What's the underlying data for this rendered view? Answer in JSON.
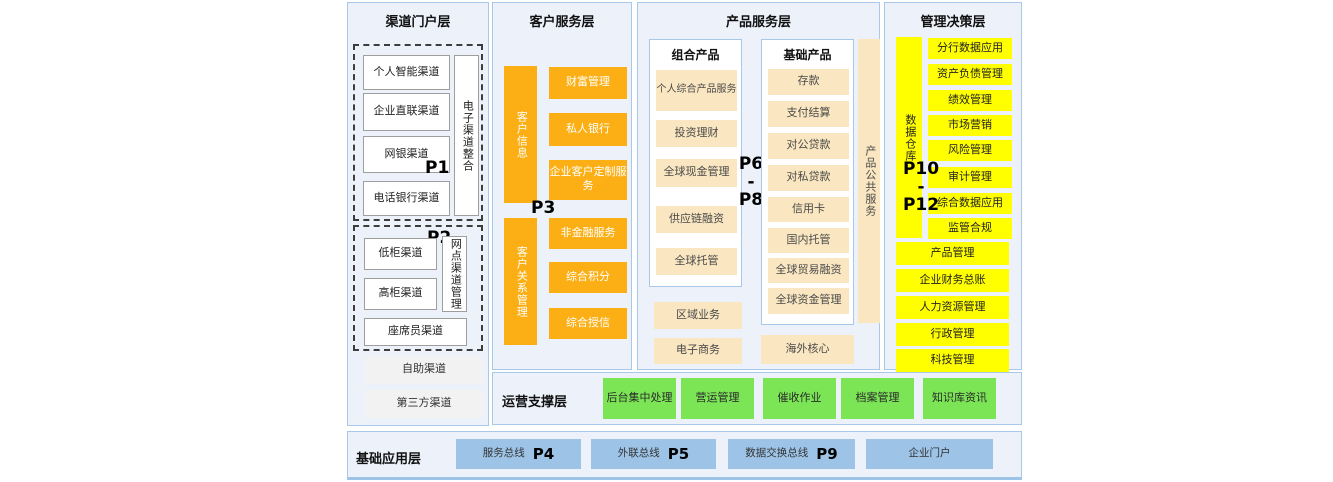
{
  "diagram": {
    "channel": {
      "title": "渠道门户层",
      "tag1": "P1",
      "tag2": "P2",
      "group1_items": [
        "个人智能渠道",
        "企业直联渠道",
        "网银渠道",
        "电话银行渠道"
      ],
      "group1_side": "电子渠道整合",
      "group2_items": [
        "低柜渠道",
        "高柜渠道"
      ],
      "group2_side": "网点渠道管理",
      "group2_wide": "座席员渠道",
      "extra_items": [
        "自助渠道",
        "第三方渠道"
      ]
    },
    "customer": {
      "title": "客户服务层",
      "tag": "P3",
      "top_bar": "客户信息",
      "top_items": [
        "财富管理",
        "私人银行",
        "企业客户定制服务"
      ],
      "bottom_bar": "客户关系管理",
      "bottom_items": [
        "非金融服务",
        "综合积分",
        "综合授信"
      ]
    },
    "product": {
      "title": "产品服务层",
      "tag_top": "P6",
      "tag_sep": "-",
      "tag_bottom": "P8",
      "combo_title": "组合产品",
      "combo_items": [
        "个人综合产品服务",
        "投资理财",
        "全球现金管理",
        "供应链融资",
        "全球托管"
      ],
      "combo_extra": [
        "区域业务",
        "电子商务"
      ],
      "basic_title": "基础产品",
      "basic_items": [
        "存款",
        "支付结算",
        "对公贷款",
        "对私贷款",
        "信用卡",
        "国内托管",
        "全球贸易融资",
        "全球资金管理"
      ],
      "basic_extra": "海外核心",
      "side_bar": "产品公共服务"
    },
    "management": {
      "title": "管理决策层",
      "bar": "数据仓库",
      "tag_top": "P10",
      "tag_sep": "-",
      "tag_bottom": "P12",
      "items": [
        "分行数据应用",
        "资产负债管理",
        "绩效管理",
        "市场营销",
        "风险管理",
        "审计管理",
        "综合数据应用",
        "监管合规"
      ],
      "wide_items": [
        "产品管理",
        "企业财务总账",
        "人力资源管理",
        "行政管理",
        "科技管理"
      ]
    },
    "operations": {
      "title": "运营支撑层",
      "items": [
        "后台集中处理",
        "营运管理",
        "催收作业",
        "档案管理",
        "知识库资讯"
      ]
    },
    "foundation": {
      "title": "基础应用层",
      "items": [
        {
          "label": "服务总线",
          "tag": "P4"
        },
        {
          "label": "外联总线",
          "tag": "P5"
        },
        {
          "label": "数据交换总线",
          "tag": "P9"
        },
        {
          "label": "企业门户",
          "tag": ""
        }
      ]
    },
    "colors": {
      "panel_bg": "#EDF2FA",
      "panel_border": "#A9C7E9",
      "orange": "#FBAF15",
      "cream": "#FAE7C1",
      "yellow": "#FFFF00",
      "green": "#7BE556",
      "blue": "#9DC3E6",
      "gray": "#F2F2F2"
    }
  }
}
